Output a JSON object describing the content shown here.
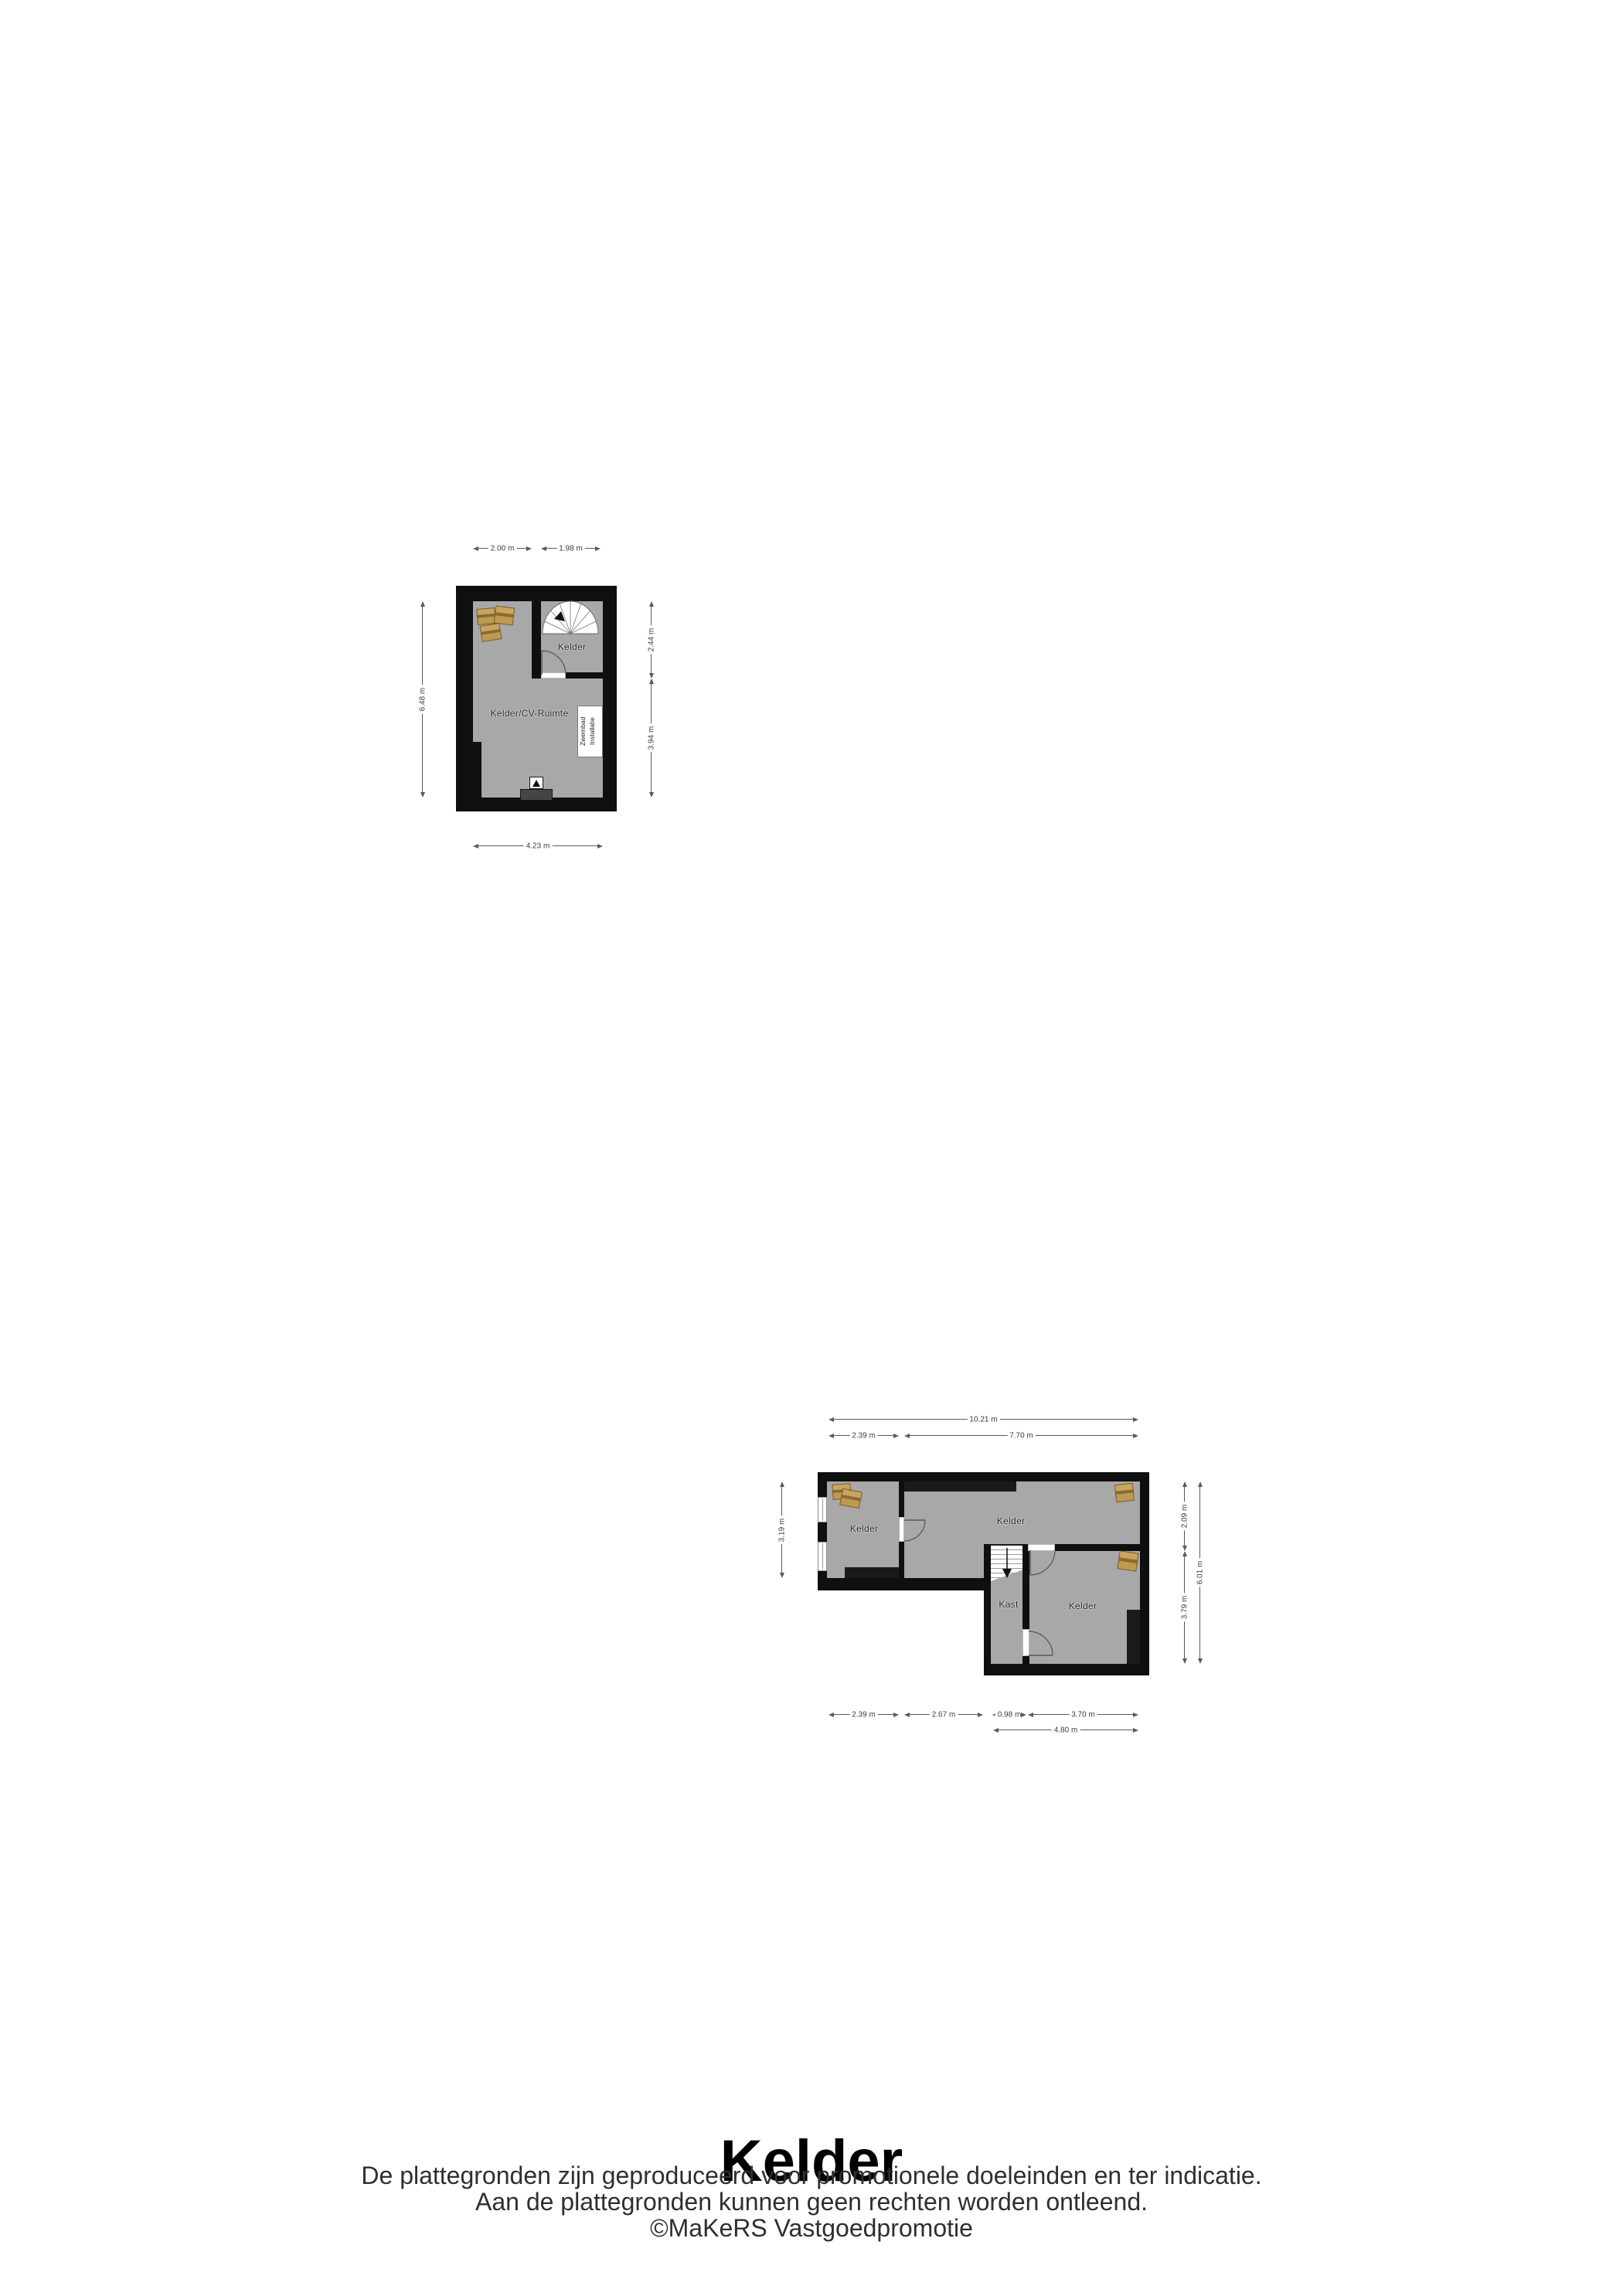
{
  "colors": {
    "wall": "#0f0f0f",
    "floor": "#a8a8a8",
    "furniture": "#1a1a1a",
    "platform": "#454545",
    "box_fill": "#c9a55e",
    "box_band": "#8a6a33",
    "box_fill2": "#bf9950",
    "stair_tread": "#9a9a9a",
    "dim_text": "#3c3c3c",
    "room_text": "#1c1c1c"
  },
  "plan_upper": {
    "rooms": {
      "stair_room": "Kelder",
      "main_room": "Kelder/CV-Ruimte"
    },
    "equipment": {
      "line1": "Zwembad",
      "line2": "Installatie"
    },
    "dims": {
      "top_left": "2.00 m",
      "top_right": "1.98 m",
      "left": "6.48 m",
      "right_top": "2.44 m",
      "right_bottom": "3.94 m",
      "bottom": "4.23 m"
    }
  },
  "plan_lower": {
    "rooms": {
      "left": "Kelder",
      "middle": "Kelder",
      "kast": "Kast",
      "bottom_right": "Kelder"
    },
    "dims": {
      "top_total": "10.21 m",
      "top_left": "2.39 m",
      "top_right": "7.70 m",
      "left": "3.19 m",
      "right_top": "2.09 m",
      "right_bottom": "3.79 m",
      "right_total": "6.01 m",
      "bottom_1": "2.39 m",
      "bottom_2": "2.67 m",
      "bottom_3": "0.98 m",
      "bottom_4": "3.70 m",
      "bottom_total": "4.80 m"
    }
  },
  "footer": {
    "title": "Kelder",
    "disclaimer_1": "De plattegronden zijn geproduceerd voor promotionele doeleinden en ter indicatie.",
    "disclaimer_2": "Aan de plattegronden kunnen geen rechten worden ontleend.",
    "credit": "©MaKeRS Vastgoedpromotie"
  }
}
